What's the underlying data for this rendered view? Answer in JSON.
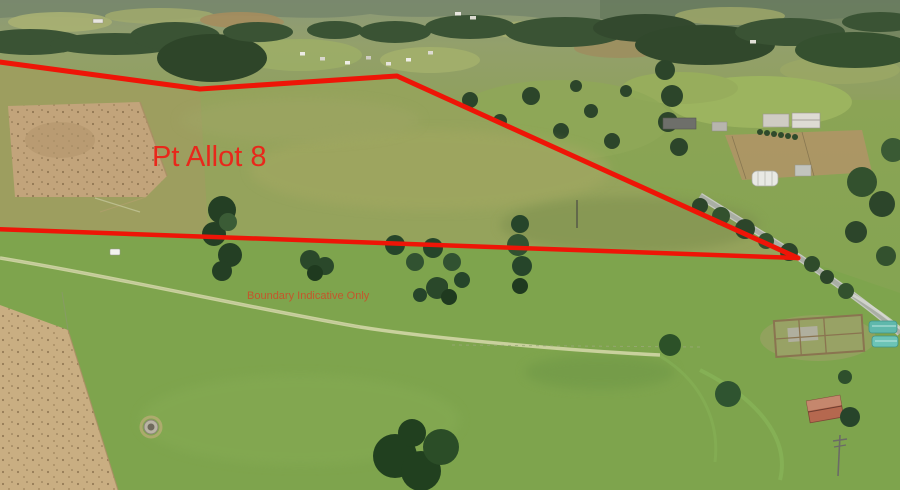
{
  "meta": {
    "title": "Aerial rural property photo with boundary overlay",
    "width_px": 900,
    "height_px": 490
  },
  "overlay": {
    "parcel_label": "Pt Allot 8",
    "disclaimer": "Boundary Indicative Only",
    "boundary_color": "#ee1507",
    "parcel_label_color": "#e8281b",
    "disclaimer_color": "#c9502a",
    "boundary_top_points": "-8,61 200,89 397,76 798,258",
    "boundary_bottom_points": "-8,229 798,258"
  },
  "scene": {
    "description": "Drone aerial photo of rolling farmland: olive-green pasture inside the red boundary, dry tan paddocks left, tree clusters mid-field, a hazy forested valley with scattered houses along the top, a lifestyle property with lawns, sheds and a large house upper right, a sealed country road at the right vertex, and below the boundary a bright green paddock with a farm track, stockyards, teal sheds and a rusty-roofed shed near the road.",
    "palette": {
      "pasture_green": "#95a35c",
      "bright_pasture_green": "#7ea44d",
      "dry_paddock_tan": "#c2a47b",
      "forest_dark_green": "#2c452a",
      "distant_haze_olive": "#8b9878",
      "road_gray": "#a9aea4",
      "shed_roof_rust": "#b5684f",
      "structure_teal": "#5fb8ac"
    },
    "features": [
      "red surveyed boundary outline (open at left edge)",
      "dry dirt paddock with cattle inside boundary (left)",
      "large dark tree cluster crossing lower boundary line",
      "pine tree clusters mid paddock",
      "farm track through lower paddock",
      "water trough circle lower left",
      "distant valley houses and forest along top",
      "country-club style lawns, hedges and buildings upper right",
      "quonset shed and gray sheds right of boundary",
      "sealed road meeting boundary vertex at right",
      "timber stockyards and teal structures lower right",
      "rust-roofed shed with trees lower right",
      "power pole lower right"
    ]
  }
}
